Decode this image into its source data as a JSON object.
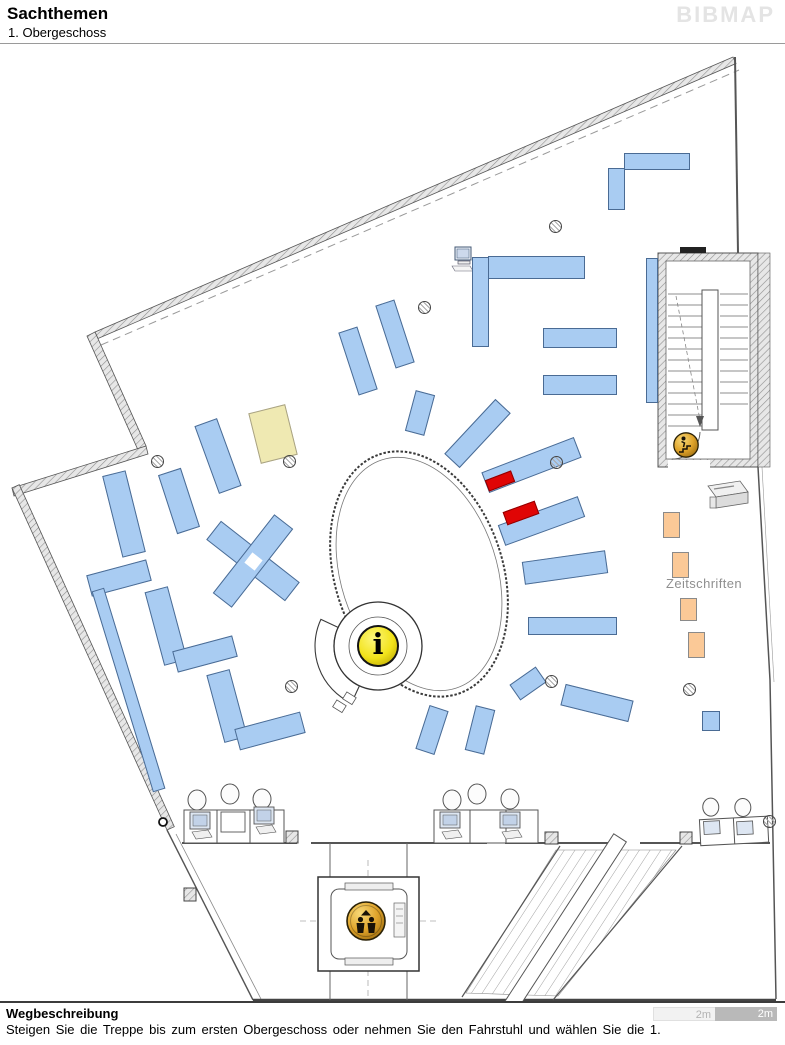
{
  "header": {
    "title": "Sachthemen",
    "subtitle": "1. Obergeschoss",
    "logo": "BIBMAP"
  },
  "footer": {
    "heading": "Wegbeschreibung",
    "instruction": "Steigen Sie die Treppe bis zum ersten Obergeschoss oder nehmen Sie den Fahrstuhl und wählen Sie die 1.",
    "scale": [
      {
        "label": "2m",
        "style": "light"
      },
      {
        "label": "2m",
        "style": "dark"
      }
    ]
  },
  "map": {
    "colors": {
      "shelf": "#A9CCF2",
      "shelfBorder": "#4A6B94",
      "special": "#EFE9B2",
      "magazine": "#FBC997",
      "magazineBorder": "#8a8a8a",
      "highlight": "#E00505",
      "gold": "#DFA32A",
      "infoYellow": "#F2E31A"
    },
    "labels": [
      {
        "text": "Zeitschriften",
        "x": 666,
        "y": 576,
        "size": 13,
        "color": "#8f8f8f"
      }
    ],
    "icons": [
      {
        "name": "info-icon",
        "x": 378,
        "y": 646,
        "r": 21,
        "glyph": "i"
      },
      {
        "name": "elevator-icon",
        "x": 366,
        "y": 921,
        "r": 20
      },
      {
        "name": "stairs-down-icon",
        "x": 686,
        "y": 445,
        "r": 13
      }
    ],
    "columns": [
      [
        158,
        462
      ],
      [
        290,
        462
      ],
      [
        425,
        308
      ],
      [
        556,
        227
      ],
      [
        557,
        463
      ],
      [
        552,
        682
      ],
      [
        292,
        687
      ],
      [
        690,
        690
      ],
      [
        770,
        822
      ]
    ],
    "shelves": [
      {
        "x": 657,
        "y": 161,
        "w": 66,
        "h": 17,
        "r": 0,
        "type": "standard"
      },
      {
        "x": 616,
        "y": 189,
        "w": 17,
        "h": 42,
        "r": 0,
        "type": "standard"
      },
      {
        "x": 536,
        "y": 267,
        "w": 97,
        "h": 23,
        "r": 0,
        "type": "standard"
      },
      {
        "x": 480,
        "y": 302,
        "w": 17,
        "h": 90,
        "r": 0,
        "type": "standard"
      },
      {
        "x": 580,
        "y": 338,
        "w": 74,
        "h": 20,
        "r": 0,
        "type": "standard"
      },
      {
        "x": 580,
        "y": 385,
        "w": 74,
        "h": 20,
        "r": 0,
        "type": "standard"
      },
      {
        "x": 652,
        "y": 330,
        "w": 12,
        "h": 145,
        "r": 0,
        "type": "standard"
      },
      {
        "x": 358,
        "y": 361,
        "w": 20,
        "h": 66,
        "r": -18,
        "type": "standard"
      },
      {
        "x": 395,
        "y": 334,
        "w": 20,
        "h": 66,
        "r": -18,
        "type": "standard"
      },
      {
        "x": 420,
        "y": 413,
        "w": 20,
        "h": 42,
        "r": 15,
        "type": "standard"
      },
      {
        "x": 477,
        "y": 433,
        "w": 21,
        "h": 75,
        "r": 43,
        "type": "standard"
      },
      {
        "x": 531,
        "y": 465,
        "w": 99,
        "h": 22,
        "r": -21,
        "type": "standard"
      },
      {
        "x": 541,
        "y": 521,
        "w": 85,
        "h": 22,
        "r": -20,
        "type": "standard"
      },
      {
        "x": 565,
        "y": 567,
        "w": 84,
        "h": 23,
        "r": -8,
        "type": "standard"
      },
      {
        "x": 572,
        "y": 626,
        "w": 89,
        "h": 18,
        "r": 0,
        "type": "standard"
      },
      {
        "x": 528,
        "y": 683,
        "w": 32,
        "h": 19,
        "r": -35,
        "type": "standard"
      },
      {
        "x": 597,
        "y": 703,
        "w": 70,
        "h": 22,
        "r": 14,
        "type": "standard"
      },
      {
        "x": 432,
        "y": 730,
        "w": 20,
        "h": 46,
        "r": 18,
        "type": "standard"
      },
      {
        "x": 480,
        "y": 730,
        "w": 20,
        "h": 46,
        "r": 14,
        "type": "standard"
      },
      {
        "x": 711,
        "y": 721,
        "w": 18,
        "h": 20,
        "r": 0,
        "type": "standard"
      },
      {
        "x": 124,
        "y": 514,
        "w": 24,
        "h": 84,
        "r": -14,
        "type": "standard"
      },
      {
        "x": 119,
        "y": 578,
        "w": 62,
        "h": 22,
        "r": -15,
        "type": "standard"
      },
      {
        "x": 179,
        "y": 501,
        "w": 24,
        "h": 62,
        "r": -18,
        "type": "standard"
      },
      {
        "x": 218,
        "y": 456,
        "w": 24,
        "h": 72,
        "r": -20,
        "type": "standard"
      },
      {
        "x": 273,
        "y": 434,
        "w": 38,
        "h": 52,
        "r": -14,
        "type": "special"
      },
      {
        "x": 253,
        "y": 561,
        "w": 100,
        "h": 24,
        "r": 38,
        "type": "standard"
      },
      {
        "x": 253,
        "y": 561,
        "w": 24,
        "h": 100,
        "r": 38,
        "type": "standard"
      },
      {
        "x": 253,
        "y": 561,
        "w": 13,
        "h": 13,
        "r": 38,
        "type": "cutout"
      },
      {
        "x": 166,
        "y": 626,
        "w": 24,
        "h": 76,
        "r": -15,
        "type": "standard"
      },
      {
        "x": 205,
        "y": 654,
        "w": 62,
        "h": 22,
        "r": -15,
        "type": "standard"
      },
      {
        "x": 227,
        "y": 706,
        "w": 24,
        "h": 70,
        "r": -15,
        "type": "standard"
      },
      {
        "x": 270,
        "y": 731,
        "w": 68,
        "h": 22,
        "r": -15,
        "type": "standard"
      },
      {
        "x": 128,
        "y": 690,
        "w": 13,
        "h": 210,
        "r": -17,
        "type": "standard"
      },
      {
        "x": 671,
        "y": 525,
        "w": 17,
        "h": 26,
        "r": 0,
        "type": "magazine"
      },
      {
        "x": 680,
        "y": 565,
        "w": 17,
        "h": 26,
        "r": 0,
        "type": "magazine"
      },
      {
        "x": 688,
        "y": 609,
        "w": 17,
        "h": 23,
        "r": 0,
        "type": "magazine"
      },
      {
        "x": 696,
        "y": 645,
        "w": 17,
        "h": 26,
        "r": 0,
        "type": "magazine"
      },
      {
        "x": 500,
        "y": 481,
        "w": 28,
        "h": 12,
        "r": -21,
        "type": "highlight"
      },
      {
        "x": 521,
        "y": 513,
        "w": 34,
        "h": 14,
        "r": -20,
        "type": "highlight"
      }
    ]
  }
}
